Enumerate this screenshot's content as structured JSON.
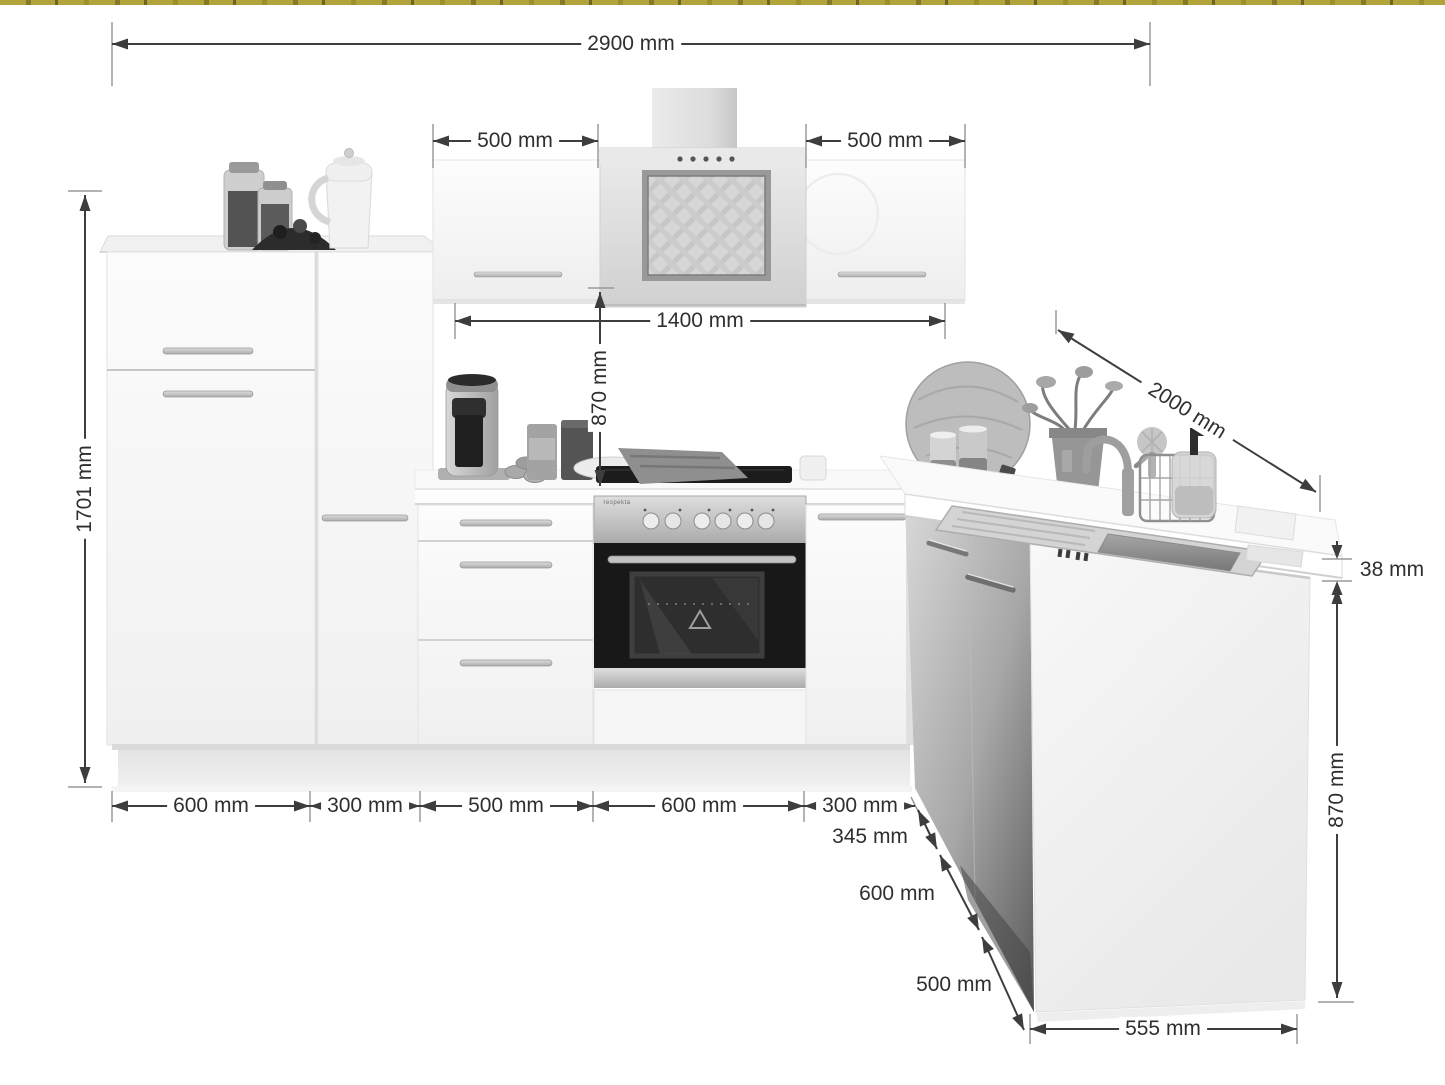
{
  "colors": {
    "dimension_line": "#3d3d3d",
    "dimension_text": "#2f2f2f",
    "top_strip": "#b2a43a"
  },
  "dimensions": {
    "total_width": "2900 mm",
    "wall_cabinet_left_width": "500 mm",
    "wall_cabinet_right_width": "500 mm",
    "wall_section_span": "1400 mm",
    "hood_to_counter_height": "870 mm",
    "tall_unit_height": "1701 mm",
    "peninsula_depth": "2000 mm",
    "worktop_thickness": "38 mm",
    "base_unit_1_width": "600 mm",
    "base_unit_2_width": "300 mm",
    "base_unit_3_width": "500 mm",
    "base_unit_4_width": "600 mm",
    "base_unit_5_width": "300 mm",
    "corner_segment_1": "345 mm",
    "corner_segment_2": "600 mm",
    "corner_segment_3": "500 mm",
    "peninsula_width": "555 mm",
    "peninsula_height": "870 mm"
  },
  "appliances": {
    "oven_brand": "respekta"
  }
}
